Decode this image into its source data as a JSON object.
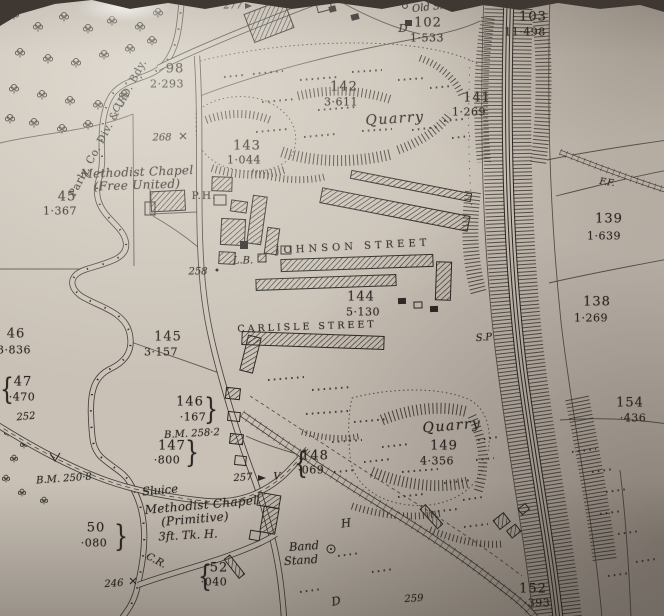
{
  "palette": {
    "paper": "#c9c1b6",
    "ink": "#2a2622",
    "background": "#3f3832"
  },
  "labels": [
    {
      "name": "boundary-label",
      "kind": "boundary",
      "text": "Parly. Co. Div. & U.D. Bdy.",
      "x": 108,
      "y": 128,
      "cls": "bdy",
      "rot": -62
    },
    {
      "name": "road-label-cr-north",
      "kind": "abbrev",
      "text": "C.R.",
      "x": 121,
      "y": 103,
      "cls": "it10",
      "rot": -55
    },
    {
      "name": "parcel-98-number",
      "kind": "parcel-number",
      "text": "98",
      "x": 175,
      "y": 69,
      "cls": "num"
    },
    {
      "name": "parcel-98-area",
      "kind": "parcel-area",
      "text": "2·293",
      "x": 167,
      "y": 84,
      "cls": "area"
    },
    {
      "name": "spot-277",
      "kind": "spot-number",
      "text": "277",
      "x": 233,
      "y": 6,
      "cls": "it10"
    },
    {
      "name": "old-shaft-label",
      "kind": "place",
      "text": "Old Shaft",
      "x": 436,
      "y": 7,
      "cls": "it10",
      "rot": -6
    },
    {
      "name": "parcel-letter-d",
      "kind": "abbrev",
      "text": "D",
      "x": 403,
      "y": 28,
      "cls": "it11"
    },
    {
      "name": "parcel-102-number",
      "kind": "parcel-number",
      "text": "102",
      "x": 428,
      "y": 23,
      "cls": "num"
    },
    {
      "name": "parcel-102-area",
      "kind": "parcel-area",
      "text": "1·533",
      "x": 427,
      "y": 38,
      "cls": "area"
    },
    {
      "name": "parcel-103-number",
      "kind": "parcel-number",
      "text": "103",
      "x": 533,
      "y": 17,
      "cls": "num"
    },
    {
      "name": "parcel-103-area",
      "kind": "parcel-area",
      "text": "11·498",
      "x": 525,
      "y": 32,
      "cls": "area"
    },
    {
      "name": "parcel-142-number",
      "kind": "parcel-number",
      "text": "142",
      "x": 344,
      "y": 87,
      "cls": "num"
    },
    {
      "name": "parcel-142-area",
      "kind": "parcel-area",
      "text": "3·611",
      "x": 341,
      "y": 102,
      "cls": "area"
    },
    {
      "name": "quarry-north-label",
      "kind": "place",
      "text": "Quarry",
      "x": 395,
      "y": 119,
      "cls": "qry",
      "rot": -4
    },
    {
      "name": "parcel-143-number",
      "kind": "parcel-number",
      "text": "143",
      "x": 247,
      "y": 146,
      "cls": "num"
    },
    {
      "name": "parcel-143-area",
      "kind": "parcel-area",
      "text": "1·044",
      "x": 244,
      "y": 160,
      "cls": "area"
    },
    {
      "name": "spot-268",
      "kind": "spot-number",
      "text": "268",
      "x": 162,
      "y": 138,
      "cls": "it10"
    },
    {
      "name": "methodist-chapel-free-united-line1",
      "kind": "place",
      "text": "Methodist Chapel",
      "x": 137,
      "y": 172,
      "cls": "chap",
      "rot": -2
    },
    {
      "name": "methodist-chapel-free-united-line2",
      "kind": "place",
      "text": "(Free United)",
      "x": 137,
      "y": 185,
      "cls": "chap",
      "rot": -2
    },
    {
      "name": "parcel-45-number",
      "kind": "parcel-number",
      "text": "45",
      "x": 67,
      "y": 197,
      "cls": "num"
    },
    {
      "name": "parcel-45-area",
      "kind": "parcel-area",
      "text": "1·367",
      "x": 60,
      "y": 211,
      "cls": "area"
    },
    {
      "name": "public-house-label",
      "kind": "abbrev",
      "text": "P.H.",
      "x": 204,
      "y": 196,
      "cls": "ph"
    },
    {
      "name": "spot-258",
      "kind": "spot-number",
      "text": "258",
      "x": 198,
      "y": 272,
      "cls": "it10"
    },
    {
      "name": "johnson-street-label",
      "kind": "street",
      "text": "JOHNSON STREET",
      "x": 353,
      "y": 247,
      "cls": "street",
      "rot": -3
    },
    {
      "name": "letter-box-label",
      "kind": "abbrev",
      "text": "L.B.",
      "x": 243,
      "y": 261,
      "cls": "it10"
    },
    {
      "name": "parcel-144-number",
      "kind": "parcel-number",
      "text": "144",
      "x": 361,
      "y": 297,
      "cls": "num"
    },
    {
      "name": "parcel-144-area",
      "kind": "parcel-area",
      "text": "5·130",
      "x": 363,
      "y": 312,
      "cls": "area"
    },
    {
      "name": "carlisle-street-label",
      "kind": "street",
      "text": "CARLISLE STREET",
      "x": 307,
      "y": 327,
      "cls": "street2",
      "rot": -2
    },
    {
      "name": "parcel-145-number",
      "kind": "parcel-number",
      "text": "145",
      "x": 168,
      "y": 337,
      "cls": "num"
    },
    {
      "name": "parcel-145-area",
      "kind": "parcel-area",
      "text": "3·157",
      "x": 161,
      "y": 352,
      "cls": "area"
    },
    {
      "name": "parcel-46-number",
      "kind": "parcel-number",
      "text": "46",
      "x": 16,
      "y": 334,
      "cls": "num"
    },
    {
      "name": "parcel-46-area",
      "kind": "parcel-area",
      "text": "3·836",
      "x": 14,
      "y": 350,
      "cls": "area"
    },
    {
      "name": "parcel-47-brace",
      "kind": "brace",
      "text": "{",
      "x": 7,
      "y": 389,
      "cls": "brace"
    },
    {
      "name": "parcel-47-number",
      "kind": "parcel-number",
      "text": "47",
      "x": 23,
      "y": 382,
      "cls": "num"
    },
    {
      "name": "parcel-47-area",
      "kind": "parcel-area",
      "text": "·470",
      "x": 22,
      "y": 397,
      "cls": "area"
    },
    {
      "name": "spot-252",
      "kind": "spot-number",
      "text": "252",
      "x": 26,
      "y": 417,
      "cls": "it10",
      "rot": -5
    },
    {
      "name": "parcel-146-number",
      "kind": "parcel-number",
      "text": "146",
      "x": 190,
      "y": 402,
      "cls": "num"
    },
    {
      "name": "parcel-146-area",
      "kind": "parcel-area",
      "text": "·167",
      "x": 193,
      "y": 417,
      "cls": "area"
    },
    {
      "name": "parcel-146-brace",
      "kind": "brace",
      "text": "}",
      "x": 211,
      "y": 409,
      "cls": "brace"
    },
    {
      "name": "benchmark-258-2",
      "kind": "benchmark",
      "text": "B.M. 258·2",
      "x": 192,
      "y": 434,
      "cls": "it10",
      "rot": -3
    },
    {
      "name": "parcel-147-number",
      "kind": "parcel-number",
      "text": "147",
      "x": 172,
      "y": 446,
      "cls": "num"
    },
    {
      "name": "parcel-147-area",
      "kind": "parcel-area",
      "text": "·800",
      "x": 167,
      "y": 460,
      "cls": "area"
    },
    {
      "name": "parcel-147-brace",
      "kind": "brace",
      "text": "}",
      "x": 192,
      "y": 452,
      "cls": "brace"
    },
    {
      "name": "benchmark-250-8",
      "kind": "benchmark",
      "text": "B.M. 250·8",
      "x": 64,
      "y": 479,
      "cls": "it10",
      "rot": -4
    },
    {
      "name": "sluice-label",
      "kind": "place",
      "text": "Sluice",
      "x": 160,
      "y": 490,
      "cls": "it11",
      "rot": -5
    },
    {
      "name": "methodist-chapel-primitive-line1",
      "kind": "place",
      "text": "Methodist Chapel",
      "x": 201,
      "y": 505,
      "cls": "chap",
      "rot": -5
    },
    {
      "name": "methodist-chapel-primitive-line2",
      "kind": "place",
      "text": "(Primitive)",
      "x": 195,
      "y": 519,
      "cls": "chap",
      "rot": -5
    },
    {
      "name": "trough-label",
      "kind": "abbrev",
      "text": "3ft. Tk. H.",
      "x": 188,
      "y": 535,
      "cls": "it11",
      "rot": -3
    },
    {
      "name": "parcel-50-number",
      "kind": "parcel-number",
      "text": "50",
      "x": 96,
      "y": 528,
      "cls": "num"
    },
    {
      "name": "parcel-50-area",
      "kind": "parcel-area",
      "text": "·080",
      "x": 94,
      "y": 543,
      "cls": "area"
    },
    {
      "name": "parcel-50-brace",
      "kind": "brace",
      "text": "}",
      "x": 121,
      "y": 536,
      "cls": "brace"
    },
    {
      "name": "road-label-cr-south",
      "kind": "abbrev",
      "text": "C.R.",
      "x": 156,
      "y": 561,
      "cls": "it10",
      "rot": 28
    },
    {
      "name": "spot-246",
      "kind": "spot-number",
      "text": "246",
      "x": 114,
      "y": 584,
      "cls": "it10",
      "rot": -4
    },
    {
      "name": "parcel-52-brace",
      "kind": "brace",
      "text": "{",
      "x": 205,
      "y": 576,
      "cls": "brace"
    },
    {
      "name": "parcel-52-number",
      "kind": "parcel-number",
      "text": "52",
      "x": 219,
      "y": 568,
      "cls": "num"
    },
    {
      "name": "parcel-52-area",
      "kind": "parcel-area",
      "text": "·040",
      "x": 214,
      "y": 582,
      "cls": "area"
    },
    {
      "name": "band-stand-line1",
      "kind": "place",
      "text": "Band",
      "x": 304,
      "y": 546,
      "cls": "it11",
      "rot": -4
    },
    {
      "name": "band-stand-line2",
      "kind": "place",
      "text": "Stand",
      "x": 301,
      "y": 560,
      "cls": "it11",
      "rot": -4
    },
    {
      "name": "parcel-148-brace",
      "kind": "brace",
      "text": "{",
      "x": 301,
      "y": 463,
      "cls": "brace"
    },
    {
      "name": "parcel-148-number",
      "kind": "parcel-number",
      "text": "148",
      "x": 315,
      "y": 456,
      "cls": "num"
    },
    {
      "name": "parcel-148-area",
      "kind": "parcel-area",
      "text": "·069",
      "x": 311,
      "y": 470,
      "cls": "area"
    },
    {
      "name": "spot-257",
      "kind": "spot-number",
      "text": "257",
      "x": 243,
      "y": 478,
      "cls": "it10",
      "rot": -4
    },
    {
      "name": "quarry-south-label",
      "kind": "place",
      "text": "Quarry",
      "x": 452,
      "y": 426,
      "cls": "qry",
      "rot": -5
    },
    {
      "name": "parcel-149-number",
      "kind": "parcel-number",
      "text": "149",
      "x": 444,
      "y": 446,
      "cls": "num"
    },
    {
      "name": "parcel-149-area",
      "kind": "parcel-area",
      "text": "4·356",
      "x": 437,
      "y": 461,
      "cls": "area"
    },
    {
      "name": "signal-post-label",
      "kind": "abbrev",
      "text": "S.P",
      "x": 484,
      "y": 338,
      "cls": "it10",
      "rot": -5
    },
    {
      "name": "parcel-141-number",
      "kind": "parcel-number",
      "text": "141",
      "x": 477,
      "y": 98,
      "cls": "num"
    },
    {
      "name": "parcel-141-area",
      "kind": "parcel-area",
      "text": "1·269",
      "x": 469,
      "y": 112,
      "cls": "area"
    },
    {
      "name": "fence-label-ff",
      "kind": "abbrev",
      "text": "F.F.",
      "x": 607,
      "y": 183,
      "cls": "it9",
      "rot": 8
    },
    {
      "name": "parcel-139-number",
      "kind": "parcel-number",
      "text": "139",
      "x": 609,
      "y": 219,
      "cls": "num"
    },
    {
      "name": "parcel-139-area",
      "kind": "parcel-area",
      "text": "1·639",
      "x": 604,
      "y": 236,
      "cls": "area"
    },
    {
      "name": "parcel-138-number",
      "kind": "parcel-number",
      "text": "138",
      "x": 597,
      "y": 302,
      "cls": "num"
    },
    {
      "name": "parcel-138-area",
      "kind": "parcel-area",
      "text": "1·269",
      "x": 591,
      "y": 318,
      "cls": "area"
    },
    {
      "name": "parcel-154-number",
      "kind": "parcel-number",
      "text": "154",
      "x": 630,
      "y": 403,
      "cls": "num"
    },
    {
      "name": "parcel-154-area",
      "kind": "parcel-area",
      "text": "·436",
      "x": 633,
      "y": 418,
      "cls": "area"
    },
    {
      "name": "parcel-152-number",
      "kind": "parcel-number",
      "text": "152",
      "x": 533,
      "y": 589,
      "cls": "num"
    },
    {
      "name": "parcel-152-area",
      "kind": "parcel-area",
      "text": "·393",
      "x": 537,
      "y": 603,
      "cls": "area"
    },
    {
      "name": "spot-259",
      "kind": "spot-number",
      "text": "259",
      "x": 414,
      "y": 599,
      "cls": "it10",
      "rot": -4
    },
    {
      "name": "road-letter-v",
      "kind": "road-letter",
      "text": "V",
      "x": 277,
      "y": 477,
      "cls": "it10"
    },
    {
      "name": "road-letter-h",
      "kind": "road-letter",
      "text": "H",
      "x": 346,
      "y": 523,
      "cls": "it11",
      "rot": -8
    },
    {
      "name": "road-letter-d",
      "kind": "road-letter",
      "text": "D",
      "x": 336,
      "y": 601,
      "cls": "it11",
      "rot": -12
    }
  ]
}
